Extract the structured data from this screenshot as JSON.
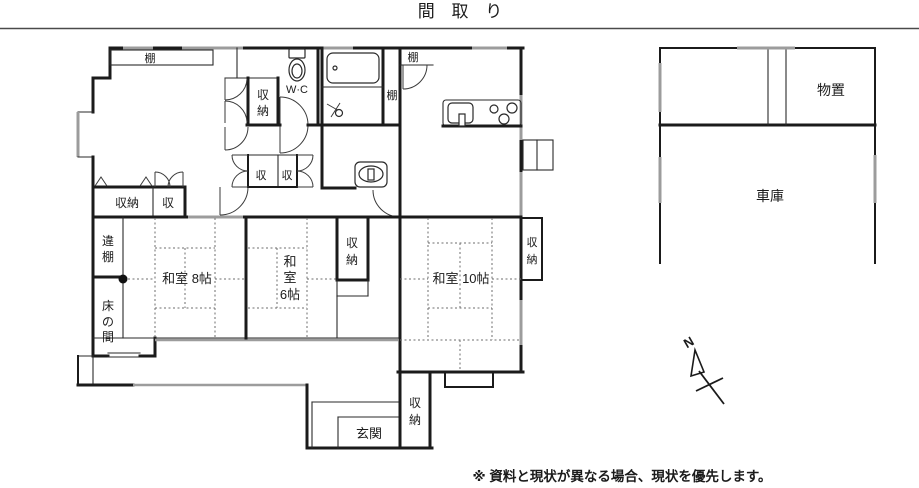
{
  "page": {
    "title": "間 取 り",
    "disclaimer": "※ 資料と現状が異なる場合、現状を優先します。"
  },
  "compass": {
    "north": "N"
  },
  "colors": {
    "wall": "#1b1b1b",
    "window_gray": "#9c9c9c",
    "tatami_line": "#6e6e6e",
    "background": "#ffffff"
  },
  "rooms": {
    "washitsu8": {
      "label": "和室 8帖"
    },
    "washitsu6": {
      "lines": [
        "和",
        "室",
        "6帖"
      ]
    },
    "washitsu10": {
      "label": "和室 10帖"
    },
    "wc": {
      "label": "W·C"
    },
    "genkan": {
      "label": "玄関"
    },
    "tokonoma": {
      "lines": [
        "床",
        "の",
        "間"
      ]
    },
    "chigaidana": {
      "lines": [
        "違",
        "棚"
      ]
    },
    "monooki": {
      "label": "物置"
    },
    "shako": {
      "label": "車庫"
    }
  },
  "closets": {
    "row_large": {
      "label": "収納"
    },
    "row_small": {
      "label": "収"
    },
    "near_wc": {
      "lines": [
        "収",
        "納"
      ]
    },
    "hall_left": {
      "label": "収"
    },
    "hall_right": {
      "label": "収"
    },
    "between_6_10": {
      "lines": [
        "収",
        "納"
      ]
    },
    "east_of_10": {
      "lines": [
        "収",
        "納"
      ]
    },
    "entry": {
      "lines": [
        "収",
        "納"
      ]
    }
  },
  "shelves": {
    "living_top": {
      "label": "棚"
    },
    "bath_side": {
      "label": "棚"
    },
    "kitchen": {
      "label": "棚"
    }
  }
}
